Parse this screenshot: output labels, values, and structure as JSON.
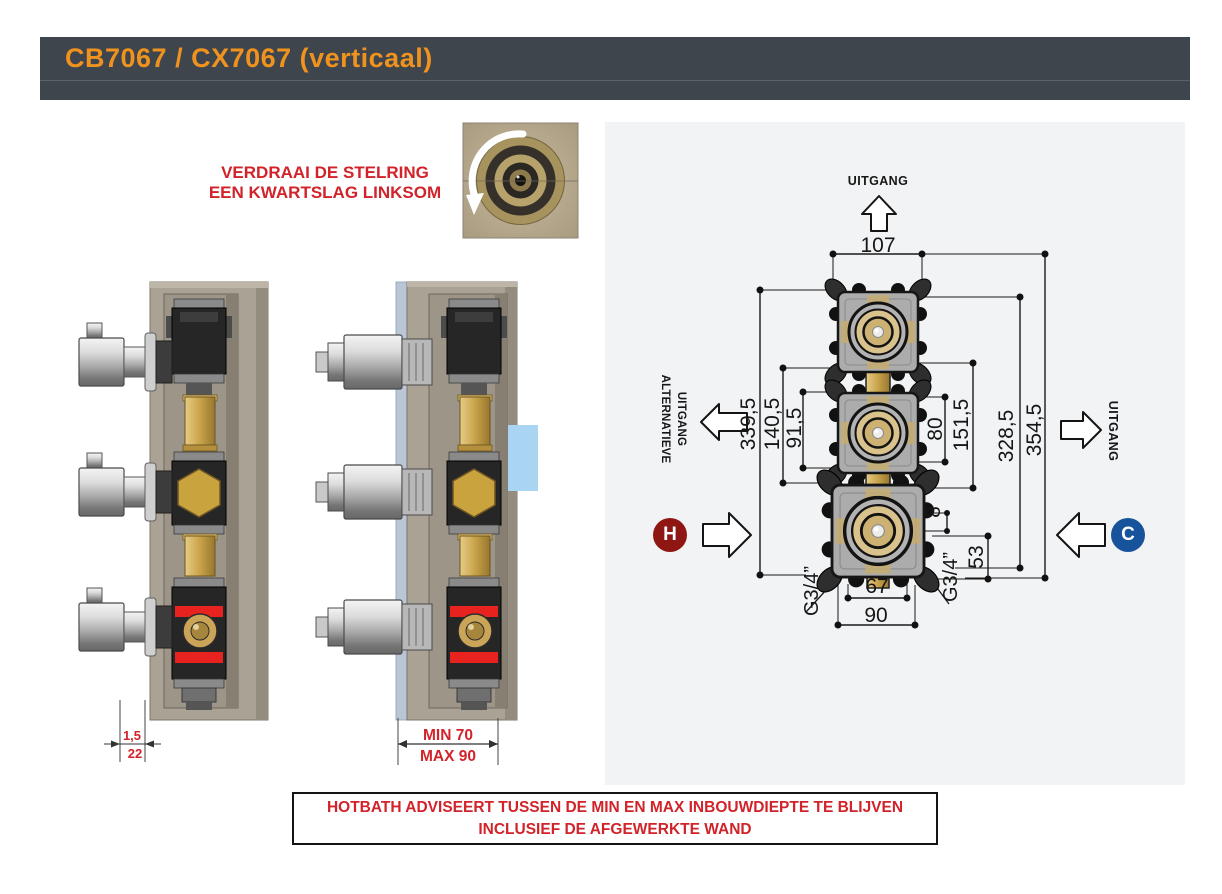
{
  "header": {
    "title": "CB7067 / CX7067 (verticaal)"
  },
  "instruction": {
    "line1": "VERDRAAI DE STELRING",
    "line2": "EEN KWARTSLAG LINKSOM"
  },
  "advisory": {
    "line1": "HOTBATH ADVISEERT TUSSEN DE MIN EN MAX INBOUWDIEPTE TE BLIJVEN",
    "line2": "INCLUSIEF DE AFGEWERKTE WAND"
  },
  "side_views": {
    "plate_thickness": "1,5",
    "wall_thickness": "22",
    "depth_min": "MIN 70",
    "depth_max": "MAX 90"
  },
  "diagram": {
    "outlet_top_label": "UITGANG",
    "alt_outlet_label_line1": "ALTERNATIEVE",
    "alt_outlet_label_line2": "UITGANG",
    "outlet_right_label": "UITGANG",
    "hot_label": "H",
    "cold_label": "C",
    "dims": {
      "d107": "107",
      "d339_5": "339,5",
      "d140_5": "140,5",
      "d91_5": "91,5",
      "d80": "80",
      "d151_5": "151,5",
      "d328_5": "328,5",
      "d354_5": "354,5",
      "d8": "8",
      "d53": "53",
      "d67": "67",
      "d90": "90",
      "thread_left": "G3/4”",
      "thread_right": "G3/4”"
    }
  },
  "colors": {
    "accent_orange": "#F0921E",
    "header_bg": "#3E454C",
    "warning_red": "#D2232A",
    "hot_red": "#8E1713",
    "cold_blue": "#17539B",
    "highlight_blue": "#A9D5F2",
    "panel_gray": "#F2F3F4"
  }
}
